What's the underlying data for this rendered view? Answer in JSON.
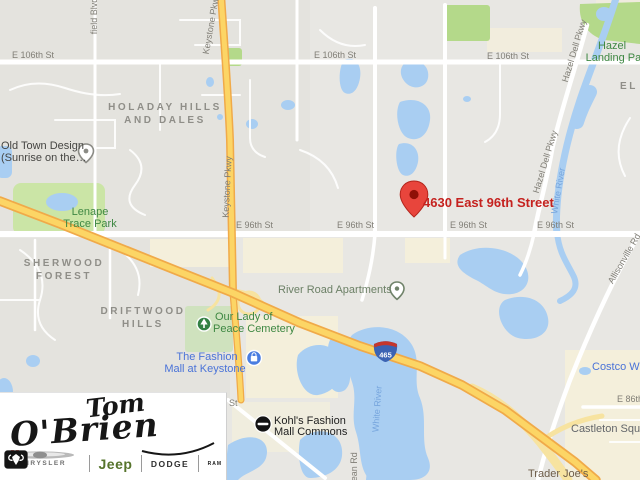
{
  "map": {
    "address_marker": {
      "label": "4630 East 96th Street"
    },
    "streets": {
      "e106_1": "E 106th St",
      "e106_2": "E 106th St",
      "e106_3": "E 106th St",
      "e96_1": "E 96th St",
      "e96_2": "E 96th St",
      "e96_3": "E 96th St",
      "e96_4": "E 96th St",
      "e86": "E 86th St",
      "partial_st": "St",
      "field_blvd": "field Blvd",
      "keystone_1": "Keystone Pkwy",
      "keystone_2": "Keystone Pkwy",
      "hazel_dell_1": "Hazel Dell Pkwy",
      "hazel_dell_2": "Hazel Dell Pkwy",
      "allisonville": "Allisonville Rd",
      "dean": "Dean Rd",
      "white_river_1": "White River",
      "white_river_2": "White River",
      "i465": "465"
    },
    "neighborhoods": {
      "holaday_1": "HOLADAY HILLS",
      "holaday_2": "AND DALES",
      "sherwood_1": "SHERWOOD",
      "sherwood_2": "FOREST",
      "driftwood_1": "DRIFTWOOD",
      "driftwood_2": "HILLS",
      "el": "EL"
    },
    "pois": {
      "old_town_1": "Old Town Design",
      "old_town_2": "(Sunrise on the…",
      "lenape_1": "Lenape",
      "lenape_2": "Trace Park",
      "hazel_landing_1": "Hazel",
      "hazel_landing_2": "Landing Park",
      "cemetery_1": "Our Lady of",
      "cemetery_2": "Peace Cemetery",
      "river_road": "River Road Apartments",
      "fashion_mall_1": "The Fashion",
      "fashion_mall_2": "Mall at Keystone",
      "kohls_1": "Kohl's Fashion",
      "kohls_2": "Mall Commons",
      "castleton": "Castleton Square",
      "trader_joes": "Trader Joe's",
      "costco": "Costco Wholesale"
    },
    "colors": {
      "marker_red": "#e8453c",
      "water_blue": "#a9cef2",
      "highway_yellow": "#fcd565",
      "highway_casing": "#f0aa49",
      "park_green": "#cbe5a6"
    }
  },
  "logo": {
    "line1": "Tom",
    "line2": "O'Brien",
    "brands": {
      "chrysler": "CHRYSLER",
      "jeep": "Jeep",
      "dodge": "DODGE",
      "ram": "RAM"
    }
  }
}
